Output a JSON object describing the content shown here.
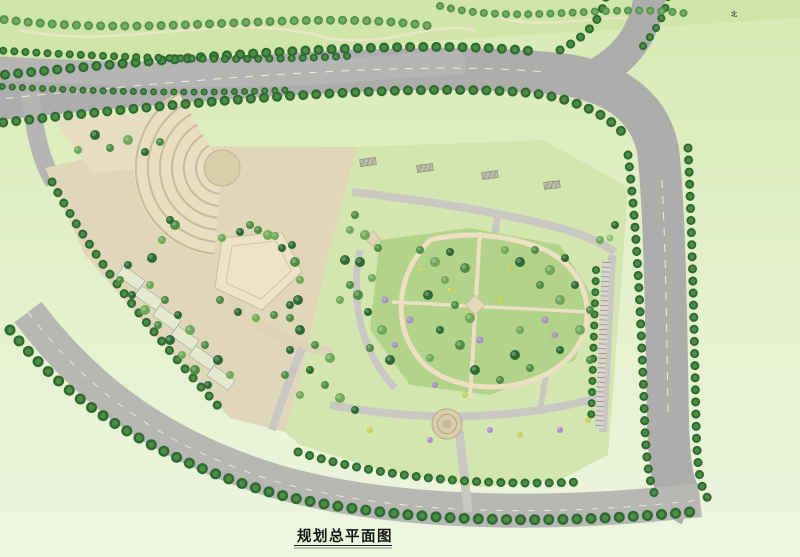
{
  "meta": {
    "title": "规划总平面图"
  },
  "compass": {
    "label": "北"
  },
  "roads": {
    "yinghe_bridge": "颖河路桥",
    "yinghe": [
      "颖",
      "河",
      "路"
    ],
    "binhe_left": [
      "规",
      "划",
      "滨",
      "河",
      "大",
      "道"
    ],
    "binhe_bottom": [
      "规",
      "划",
      "滨",
      "河",
      "大",
      "道"
    ],
    "tianan": [
      "路",
      "安",
      "天",
      "划",
      "规"
    ],
    "dim_yinghe": "25.0m",
    "dim_tianan": "25.0m"
  },
  "site_labels": [
    {
      "t": "绿化广场",
      "x": 89,
      "y": 148,
      "s": 5
    },
    {
      "t": "广场",
      "x": 284,
      "y": 193,
      "s": 5,
      "c": "#4a4a40"
    },
    {
      "t": "中心广场",
      "x": 256,
      "y": 266,
      "s": 5.5,
      "ls": 1
    },
    {
      "t": "消防出入口",
      "x": 27,
      "y": 188,
      "s": 4.2
    },
    {
      "t": "人行出入口",
      "x": 167,
      "y": 382,
      "s": 4
    },
    {
      "t": "车行出入口",
      "x": 258,
      "y": 447,
      "s": 4
    },
    {
      "t": "主入口",
      "x": 471,
      "y": 523,
      "s": 4.5
    },
    {
      "t": "次入口",
      "x": 625,
      "y": 345,
      "s": 4
    },
    {
      "t": "入口景观",
      "x": 446,
      "y": 409,
      "s": 3.6,
      "c": "#3f4a38"
    },
    {
      "t": "消防登高面",
      "x": 203,
      "y": 162,
      "s": 4,
      "c": "#efeee6"
    },
    {
      "t": "消防登高面",
      "x": 312,
      "y": 157,
      "s": 4,
      "c": "#efeee6"
    },
    {
      "t": "消防登高面",
      "x": 404,
      "y": 209,
      "s": 3.4,
      "r": 7,
      "c": "#55554d"
    },
    {
      "t": "消防登高面",
      "x": 504,
      "y": 222,
      "s": 3.4,
      "r": 9,
      "c": "#55554d"
    },
    {
      "t": "消防登高面",
      "x": 593,
      "y": 268,
      "s": 3.4,
      "r": 72,
      "c": "#55554d"
    },
    {
      "t": "3F",
      "x": 157,
      "y": 194,
      "s": 3.6
    },
    {
      "t": "裙房",
      "x": 161,
      "y": 201,
      "s": 3.6
    },
    {
      "t": "S-3栋",
      "x": 213,
      "y": 220,
      "s": 3.6
    },
    {
      "t": "S-1栋",
      "x": 133,
      "y": 247,
      "s": 3.5
    },
    {
      "t": "H=15.3m",
      "x": 133,
      "y": 252,
      "s": 2.9
    },
    {
      "t": "S-2栋",
      "x": 322,
      "y": 227,
      "s": 3.5
    },
    {
      "t": "H=15.6m",
      "x": 322,
      "y": 232,
      "s": 2.9
    },
    {
      "t": "商业",
      "x": 322,
      "y": 241,
      "s": 4.2
    },
    {
      "t": "商业",
      "x": 184,
      "y": 301,
      "s": 4.2,
      "c": "#3c3c34"
    },
    {
      "t": "25.0m",
      "x": 484,
      "y": 61,
      "s": 3.2,
      "r": 96,
      "c": "#555"
    },
    {
      "t": "25.0m",
      "x": 676,
      "y": 300,
      "s": 3.2,
      "r": -84,
      "c": "#555"
    }
  ],
  "coords": [
    {
      "x": "X=368195.102",
      "y": "Y=38629027.458",
      "px": 152,
      "py": 117
    },
    {
      "x": "X=368058.458",
      "y": "Y=38629057.869",
      "px": 128,
      "py": 404
    },
    {
      "x": "X=367994.394",
      "y": "Y=38629076.104",
      "px": 236,
      "py": 486
    },
    {
      "x": "X=367990.173",
      "y": "Y=38629089.323",
      "px": 600,
      "py": 473
    }
  ],
  "buildings": [
    {
      "id": "h1",
      "floors": "21F",
      "name": "1#酒店",
      "height": "H=96.6m"
    },
    {
      "id": "h2",
      "floors": "8F",
      "name": "2#酒店",
      "height": "H=39.1m"
    },
    {
      "id": "r10",
      "floors": "16F",
      "height": "H=48.2m",
      "name": "10栋"
    },
    {
      "id": "r11",
      "floors": "16F",
      "height": "H=48.2m",
      "name": "11栋"
    },
    {
      "id": "r12",
      "floors": "16F",
      "height": "H=48.2m",
      "name": "12栋"
    },
    {
      "id": "r8",
      "floors": "16F",
      "height": "H=48.2m",
      "name": "8栋"
    },
    {
      "id": "r9",
      "floors": "16F",
      "height": "H=48.2m",
      "name": "9栋"
    },
    {
      "id": "r6",
      "floors": "11F",
      "height": "H=33.5m",
      "name": "6栋"
    },
    {
      "id": "r7",
      "floors": "11F",
      "height": "H=33.7m",
      "name": "7栋"
    },
    {
      "id": "r1",
      "floors": "6F",
      "height": "H=19.2m",
      "name": "1栋"
    },
    {
      "id": "r2",
      "floors": "11F",
      "height": "H=33.7m",
      "name": "2栋"
    },
    {
      "id": "r3",
      "floors": "11F",
      "height": "H=33.7m",
      "name": "3栋"
    },
    {
      "id": "r5",
      "floors": "6F",
      "height": "H=19.2m",
      "name": "5栋"
    },
    {
      "id": "pd1",
      "floors": "",
      "height": "H=9.9m",
      "name": "配电房"
    },
    {
      "id": "pd2",
      "floors": "1F",
      "height": "H=9.9m",
      "name": "配套用房"
    },
    {
      "id": "c3f",
      "floors": "3F",
      "height": "",
      "name": ""
    }
  ],
  "tables": [
    {
      "name": "phase1-table",
      "title": "地块一期经济技术指标",
      "headers": [
        "项目",
        "单位",
        "数值",
        "备注"
      ],
      "groups": [
        {
          "label": "规模指标",
          "from": 0,
          "to": 11
        },
        {
          "label": "环境指标",
          "from": 12,
          "to": 15
        },
        {
          "label": "配建停车",
          "from": 16,
          "to": 19
        }
      ],
      "subs": [
        {
          "label": "其中",
          "from": 3,
          "to": 9
        },
        {
          "label": "其中",
          "from": 17,
          "to": 18
        }
      ],
      "rows": [
        [
          "用地面积",
          "m²",
          "21828.96",
          "约32.74亩"
        ],
        [
          "总建筑面积",
          "m²",
          "57457.42",
          ""
        ],
        [
          "计容建筑面积",
          "m²",
          "42455.16",
          "计容"
        ],
        [
          "1#酒店",
          "m²",
          "20895.66",
          ""
        ],
        [
          "2#酒店",
          "m²",
          "7989.31",
          ""
        ],
        [
          "商业",
          "m²",
          "14384.13",
          ""
        ],
        [
          "配套用房",
          "m²",
          "276.72",
          ""
        ],
        [
          "物管服务用房",
          "m²",
          "180.18",
          "不计容"
        ],
        [
          "消防控制室",
          "m²",
          "36.52",
          ""
        ],
        [
          "公厕",
          "m²",
          "60.04",
          ""
        ],
        [
          "配电房",
          "m²",
          "180",
          "不计容"
        ],
        [
          "地下建筑面积",
          "m²",
          "14202.76",
          "不计容|含车库设备房"
        ],
        [
          "绿地面积",
          "m²",
          "7036.33",
          ""
        ],
        [
          "容积率",
          "",
          "1.99",
          "≤2.0"
        ],
        [
          "建筑密度",
          "%",
          "32.2",
          "≤40%"
        ],
        [
          "绿地率",
          "%",
          "20.2",
          "≥20%"
        ],
        [
          "机动车总停车位",
          "辆",
          "349",
          "按规范配建"
        ],
        [
          "地面停车",
          "辆",
          "53",
          ""
        ],
        [
          "地下车位",
          "辆",
          "296",
          ""
        ],
        [
          "非机动车总停车位",
          "辆",
          "3280",
          "按规范配建"
        ]
      ],
      "note": "注：以上技术经济指标最终以政府主管部门审批为准。"
    },
    {
      "name": "phase2-table",
      "title": "地块二期经济技术指标",
      "headers": [
        "项目",
        "单位",
        "数值",
        "备注"
      ],
      "groups": [
        {
          "label": "规模指标",
          "from": 0,
          "to": 17
        },
        {
          "label": "环境指标",
          "from": 18,
          "to": 21
        },
        {
          "label": "配建停车",
          "from": 22,
          "to": 25
        }
      ],
      "subs": [
        {
          "label": "其中",
          "from": 3,
          "to": 14
        },
        {
          "label": "其中",
          "from": 23,
          "to": 24
        }
      ],
      "rows": [
        [
          "用地面积",
          "m²",
          "31441.51",
          "约47.16亩"
        ],
        [
          "总建筑面积",
          "m²",
          "91107.63",
          ""
        ],
        [
          "计容总建筑面积",
          "m²",
          "62906.43",
          "计容"
        ],
        [
          "住宅",
          "m²",
          "60132.51",
          "500户"
        ],
        [
          "8-11层住宅",
          "m²",
          "17173.83",
          "180户"
        ],
        [
          "18层住宅",
          "m²",
          "42958.68",
          "320户"
        ],
        [
          "配套用房",
          "m²",
          "1466.12",
          ""
        ],
        [
          "物管服务用房",
          "m²",
          "248.71",
          "不计容"
        ],
        [
          "养老服务用房",
          "m²",
          "126.10",
          "不计容"
        ],
        [
          "消防控制室",
          "m²",
          "36.73",
          ""
        ],
        [
          "室内文体活动站",
          "m²",
          "343.60",
          "不计容"
        ],
        [
          "公厕",
          "m²",
          "59.98",
          ""
        ],
        [
          "门卫",
          "m²",
          "45",
          ""
        ],
        [
          "开闭所",
          "m²",
          "126.87",
          ""
        ],
        [
          "配电房",
          "m²",
          "677.13",
          ""
        ],
        [
          "地下建筑面积",
          "m²",
          "28507",
          "不计容|含车库设备房"
        ],
        [
          "规划住宅总套数",
          "套",
          "500",
          ""
        ],
        [
          "规划住宅总人口数",
          "人",
          "1600",
          "按3.2人/户"
        ],
        [
          "绿地面积",
          "m²",
          "8256.79",
          ""
        ],
        [
          "容积率",
          "",
          "1.99",
          "≤2.0"
        ],
        [
          "建筑密度",
          "%",
          "19.9",
          "≤30%"
        ],
        [
          "绿地率",
          "%",
          "35.4",
          "≥35%"
        ],
        [
          "机动车总停车位",
          "辆",
          "627",
          "按1:1.2配建"
        ],
        [
          "地面停车",
          "辆",
          "111",
          "≤总量20%"
        ],
        [
          "地下车位",
          "辆",
          "516",
          ""
        ],
        [
          "非机动车总停车位",
          "辆",
          "1253",
          "按规范配建"
        ]
      ],
      "note": "注：地块二期技术经济指标最终以政府主管部门审批为准。"
    }
  ],
  "legend": {
    "title": "图例",
    "left": [
      {
        "sym": "road",
        "label": "城市道路"
      },
      {
        "sym": "redline",
        "label": "用地红线"
      },
      {
        "sym": "dashline",
        "label": "建筑控制线"
      },
      {
        "sym": "outline",
        "label": "建筑轮廓线"
      },
      {
        "sym": "garageline",
        "label": "地下车库范围线"
      }
    ],
    "right": [
      {
        "sym": "garage-entry",
        "label": "地下车库出入口"
      },
      {
        "sym": "trash",
        "label": "垃圾收集点"
      },
      {
        "sym": "fire",
        "label": "消防扑救场地"
      },
      {
        "sym": "main-entry",
        "label": "小区主入口"
      },
      {
        "sym": "sub-entry",
        "label": "小区次入口"
      }
    ]
  }
}
